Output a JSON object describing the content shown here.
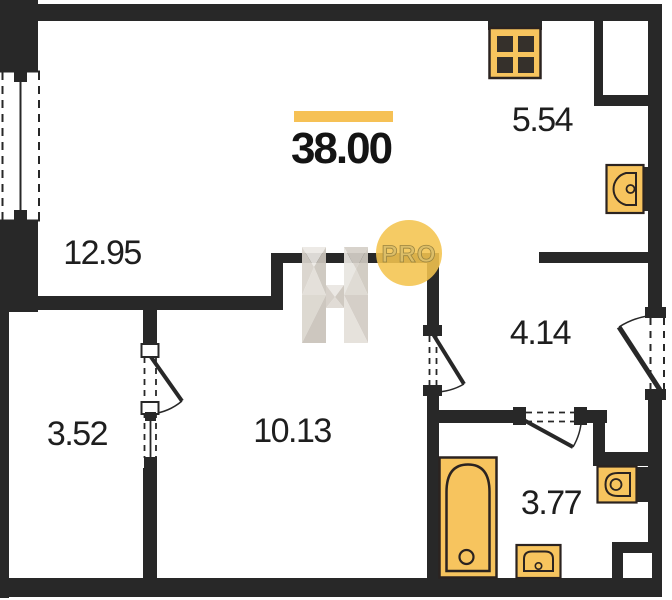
{
  "floorplan": {
    "total_area": "38.00",
    "rooms": {
      "living": {
        "area": "12.95"
      },
      "kitchen": {
        "area": "5.54"
      },
      "hallway": {
        "area": "4.14"
      },
      "loggia": {
        "area": "3.52"
      },
      "bedroom": {
        "area": "10.13"
      },
      "bathroom": {
        "area": "3.77"
      }
    },
    "watermark": {
      "badge": "PRO",
      "letter": "H"
    },
    "fixtures": [
      "stove-icon",
      "kitchen-sink-icon",
      "toilet-icon",
      "bathtub-icon",
      "bathroom-sink-icon"
    ],
    "colors": {
      "wall": "#282828",
      "fixture_fill": "#F7C45E",
      "fixture_stroke": "#2B2320",
      "accent": "#F6C155",
      "text": "#1E1E1E",
      "watermark_badge": "#F4C44F",
      "watermark_letter": "#D8D3CB"
    }
  }
}
